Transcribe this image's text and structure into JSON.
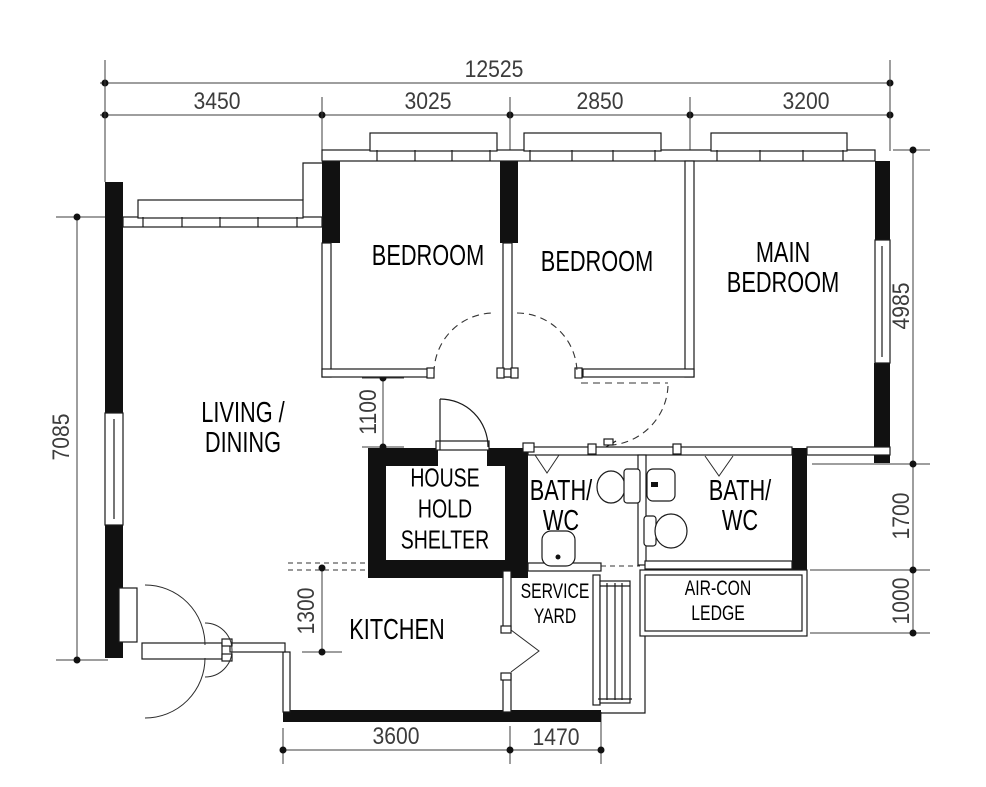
{
  "rooms": {
    "bedroom1": "BEDROOM",
    "bedroom2": "BEDROOM",
    "main_bedroom": "MAIN\nBEDROOM",
    "living_dining": "LIVING /\nDINING",
    "household_shelter": "HOUSE\nHOLD\nSHELTER",
    "bath_wc_1": "BATH/\nWC",
    "bath_wc_2": "BATH/\nWC",
    "service_yard": "SERVICE\nYARD",
    "aircon_ledge": "AIR-CON\nLEDGE",
    "kitchen": "KITCHEN"
  },
  "dimensions": {
    "total_width": "12525",
    "top": [
      "3450",
      "3025",
      "2850",
      "3200"
    ],
    "left_height": "7085",
    "right": [
      "4985",
      "1700",
      "1000"
    ],
    "bottom": [
      "3600",
      "1470"
    ],
    "interior": [
      "1100",
      "1300"
    ]
  },
  "line_color": "#1a1a1a",
  "dim_color": "#3c3c3c"
}
